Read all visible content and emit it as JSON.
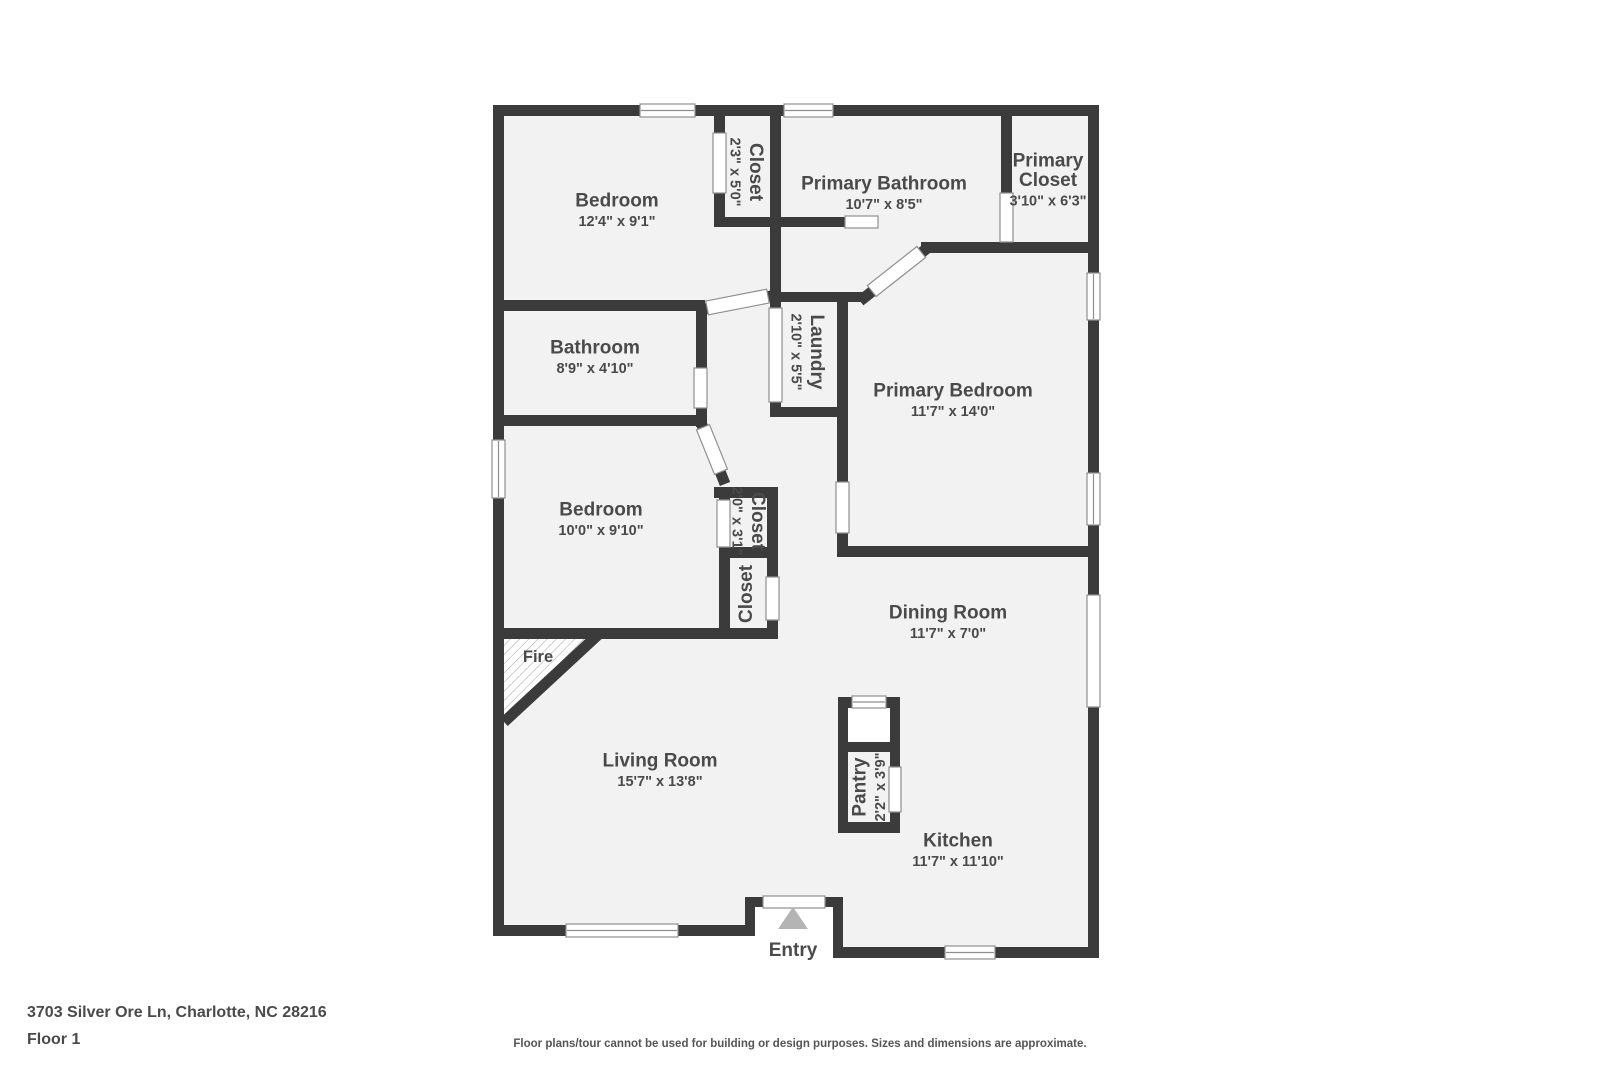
{
  "title": "Floor plan",
  "colors": {
    "wall": "#3b3b3b",
    "floor": "#f2f2f2",
    "label": "#4a4a4a",
    "label_secondary": "#555555",
    "opening_outline": "#8f8f8f",
    "hatch": "#a9a9a9",
    "entry_arrow": "#b4b4b4",
    "background": "#ffffff"
  },
  "footer": {
    "address": "3703 Silver Ore Ln, Charlotte, NC 28216",
    "floor": "Floor 1",
    "disclaimer": "Floor plans/tour cannot be used for building or design purposes. Sizes and dimensions are approximate."
  },
  "plan": {
    "labels": [
      {
        "id": "bedroom-top",
        "name": "Bedroom",
        "dims": "12'4\" x 9'1\"",
        "x": 617,
        "y": 210,
        "r": 0
      },
      {
        "id": "closet-top",
        "name": "Closet",
        "dims": "2'3\" x 5'0\"",
        "x": 746,
        "y": 172,
        "r": 90
      },
      {
        "id": "primary-bathroom",
        "name": "Primary Bathroom",
        "dims": "10'7\" x 8'5\"",
        "x": 884,
        "y": 193,
        "r": 0
      },
      {
        "id": "primary-closet",
        "name": "Primary",
        "name2": "Closet",
        "dims": "3'10\" x 6'3\"",
        "x": 1048,
        "y": 180,
        "r": 0
      },
      {
        "id": "bathroom",
        "name": "Bathroom",
        "dims": "8'9\" x 4'10\"",
        "x": 595,
        "y": 357,
        "r": 0
      },
      {
        "id": "laundry",
        "name": "Laundry",
        "dims": "2'10\" x 5'5\"",
        "x": 807,
        "y": 352,
        "r": 90
      },
      {
        "id": "primary-bedroom",
        "name": "Primary Bedroom",
        "dims": "11'7\" x 14'0\"",
        "x": 953,
        "y": 400,
        "r": 0
      },
      {
        "id": "bedroom-mid",
        "name": "Bedroom",
        "dims": "10'0\" x 9'10\"",
        "x": 601,
        "y": 519,
        "r": 0
      },
      {
        "id": "closet-bedroom",
        "name": "Closet",
        "dims": "2'0\" x 3'1\"",
        "x": 748,
        "y": 521,
        "r": 90
      },
      {
        "id": "closet-hall",
        "name": "Closet",
        "dims": "",
        "x": 746,
        "y": 594,
        "r": -90
      },
      {
        "id": "dining-room",
        "name": "Dining Room",
        "dims": "11'7\" x 7'0\"",
        "x": 948,
        "y": 622,
        "r": 0
      },
      {
        "id": "living-room",
        "name": "Living Room",
        "dims": "15'7\" x 13'8\"",
        "x": 660,
        "y": 770,
        "r": 0
      },
      {
        "id": "pantry",
        "name": "Pantry",
        "dims": "2'2\" x 3'9\"",
        "x": 869,
        "y": 787,
        "r": -90
      },
      {
        "id": "kitchen",
        "name": "Kitchen",
        "dims": "11'7\" x 11'10\"",
        "x": 958,
        "y": 850,
        "r": 0
      },
      {
        "id": "fireplace",
        "name": "Fire",
        "dims": "",
        "x": 538,
        "y": 656,
        "r": 0,
        "small": true
      },
      {
        "id": "entry",
        "name": "Entry",
        "dims": "",
        "x": 793,
        "y": 950,
        "r": 0
      }
    ]
  }
}
